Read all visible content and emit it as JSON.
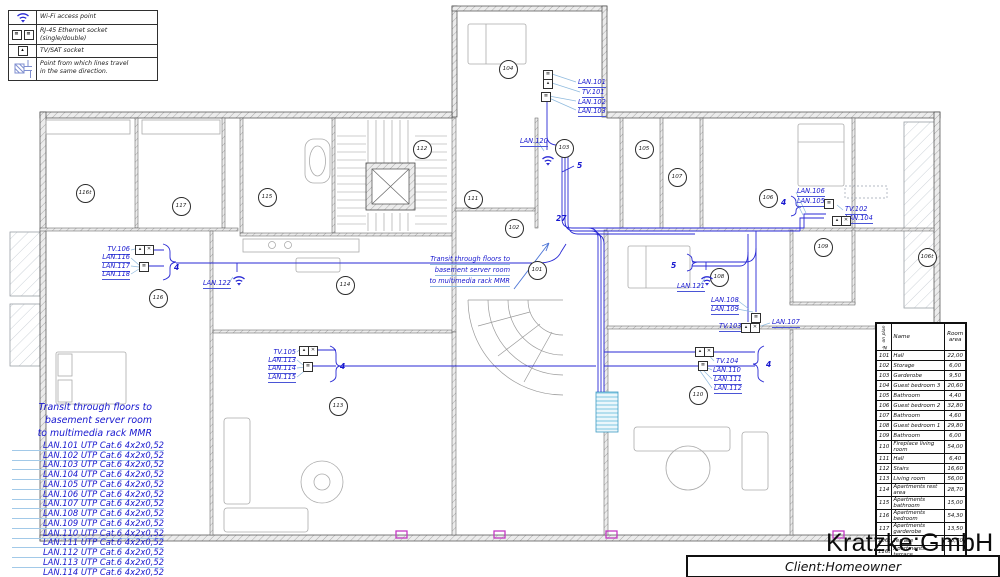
{
  "legend": {
    "items": [
      {
        "icon": "wifi-icon",
        "label": "Wi-Fi access point"
      },
      {
        "icon": "rj45-double-icon",
        "label": "RJ-45 Ethernet socket (single/double)"
      },
      {
        "icon": "tv-sat-icon",
        "label": "TV/SAT socket"
      },
      {
        "icon": "direction-icon",
        "label": "Point from which lines travel\nin the same direction."
      }
    ]
  },
  "notes": {
    "center": [
      "Transit through floors to",
      "basement server room",
      "to multimedia rack MMR"
    ],
    "bottom": [
      "Transit through floors to",
      "basement server room",
      "to multimedia rack MMR"
    ]
  },
  "cable_list": [
    "LAN.101 UTP Cat.6 4x2x0,52",
    "LAN.102 UTP Cat.6 4x2x0,52",
    "LAN.103 UTP Cat.6 4x2x0,52",
    "LAN.104 UTP Cat.6 4x2x0,52",
    "LAN.105 UTP Cat.6 4x2x0,52",
    "LAN.106 UTP Cat.6 4x2x0,52",
    "LAN.107 UTP Cat.6 4x2x0,52",
    "LAN.108 UTP Cat.6 4x2x0,52",
    "LAN.109 UTP Cat.6 4x2x0,52",
    "LAN.110 UTP Cat.6 4x2x0,52",
    "LAN.111 UTP Cat.6 4x2x0,52",
    "LAN.112 UTP Cat.6 4x2x0,52",
    "LAN.113 UTP Cat.6 4x2x0,52",
    "LAN.114 UTP Cat.6 4x2x0,52"
  ],
  "plan": {
    "rooms": [
      {
        "id": "104",
        "x": 507,
        "y": 68
      },
      {
        "id": "112",
        "x": 421,
        "y": 148
      },
      {
        "id": "103",
        "x": 563,
        "y": 147
      },
      {
        "id": "105",
        "x": 643,
        "y": 148
      },
      {
        "id": "107",
        "x": 676,
        "y": 176
      },
      {
        "id": "116t",
        "x": 84,
        "y": 192
      },
      {
        "id": "117",
        "x": 180,
        "y": 205
      },
      {
        "id": "115",
        "x": 266,
        "y": 196
      },
      {
        "id": "111",
        "x": 472,
        "y": 198
      },
      {
        "id": "106",
        "x": 767,
        "y": 197
      },
      {
        "id": "102",
        "x": 513,
        "y": 227
      },
      {
        "id": "109",
        "x": 822,
        "y": 246
      },
      {
        "id": "106t",
        "x": 926,
        "y": 256
      },
      {
        "id": "101",
        "x": 536,
        "y": 269
      },
      {
        "id": "108",
        "x": 718,
        "y": 276
      },
      {
        "id": "116",
        "x": 157,
        "y": 297
      },
      {
        "id": "114",
        "x": 344,
        "y": 284
      },
      {
        "id": "113",
        "x": 337,
        "y": 405
      },
      {
        "id": "110",
        "x": 697,
        "y": 394
      }
    ],
    "labels": [
      {
        "t": "LAN.101",
        "x": 578,
        "y": 79,
        "a": "l"
      },
      {
        "t": "TV.101",
        "x": 582,
        "y": 89,
        "a": "l"
      },
      {
        "t": "LAN.102",
        "x": 578,
        "y": 99,
        "a": "l"
      },
      {
        "t": "LAN.103",
        "x": 578,
        "y": 108,
        "a": "l"
      },
      {
        "t": "TV.106",
        "x": 130,
        "y": 246,
        "a": "r"
      },
      {
        "t": "LAN.116",
        "x": 130,
        "y": 254,
        "a": "r"
      },
      {
        "t": "LAN.117",
        "x": 130,
        "y": 263,
        "a": "r"
      },
      {
        "t": "LAN.118",
        "x": 130,
        "y": 271,
        "a": "r"
      },
      {
        "t": "TV.105",
        "x": 296,
        "y": 349,
        "a": "r"
      },
      {
        "t": "LAN.113",
        "x": 296,
        "y": 357,
        "a": "r"
      },
      {
        "t": "LAN.114",
        "x": 296,
        "y": 365,
        "a": "r"
      },
      {
        "t": "LAN.115",
        "x": 296,
        "y": 374,
        "a": "r"
      },
      {
        "t": "TV.104",
        "x": 716,
        "y": 358,
        "a": "l"
      },
      {
        "t": "LAN.110",
        "x": 713,
        "y": 367,
        "a": "l"
      },
      {
        "t": "LAN.111",
        "x": 714,
        "y": 376,
        "a": "l"
      },
      {
        "t": "LAN.112",
        "x": 714,
        "y": 385,
        "a": "l"
      },
      {
        "t": "LAN.106",
        "x": 797,
        "y": 188,
        "a": "l"
      },
      {
        "t": "LAN.105",
        "x": 797,
        "y": 198,
        "a": "l"
      },
      {
        "t": "TV.102",
        "x": 845,
        "y": 206,
        "a": "l"
      },
      {
        "t": "LAN.104",
        "x": 845,
        "y": 215,
        "a": "l"
      },
      {
        "t": "LAN.121",
        "x": 677,
        "y": 283,
        "a": "l"
      },
      {
        "t": "LAN.108",
        "x": 711,
        "y": 297,
        "a": "l"
      },
      {
        "t": "LAN.109",
        "x": 711,
        "y": 306,
        "a": "l"
      },
      {
        "t": "TV.103",
        "x": 719,
        "y": 323,
        "a": "l"
      },
      {
        "t": "LAN.107",
        "x": 772,
        "y": 319,
        "a": "l"
      },
      {
        "t": "LAN.120",
        "x": 520,
        "y": 138,
        "a": "l"
      },
      {
        "t": "LAN.122",
        "x": 203,
        "y": 280,
        "a": "l"
      },
      {
        "t": "4",
        "x": 174,
        "y": 264,
        "a": "l",
        "c": 1
      },
      {
        "t": "4",
        "x": 340,
        "y": 363,
        "a": "l",
        "c": 1
      },
      {
        "t": "4",
        "x": 781,
        "y": 199,
        "a": "l",
        "c": 1
      },
      {
        "t": "4",
        "x": 766,
        "y": 361,
        "a": "l",
        "c": 1
      },
      {
        "t": "5",
        "x": 577,
        "y": 162,
        "a": "l",
        "c": 1
      },
      {
        "t": "5",
        "x": 671,
        "y": 262,
        "a": "l",
        "c": 1
      },
      {
        "t": "27",
        "x": 556,
        "y": 215,
        "a": "l",
        "c": 1
      }
    ],
    "sockets": [
      {
        "x": 543,
        "y": 70,
        "g": "≣"
      },
      {
        "x": 543,
        "y": 79,
        "g": "▴"
      },
      {
        "x": 541,
        "y": 92,
        "g": "≣"
      },
      {
        "x": 135,
        "y": 245,
        "g": "▴"
      },
      {
        "x": 144,
        "y": 245,
        "g": "✕"
      },
      {
        "x": 139,
        "y": 262,
        "g": "≣"
      },
      {
        "x": 299,
        "y": 346,
        "g": "▴"
      },
      {
        "x": 308,
        "y": 346,
        "g": "✕"
      },
      {
        "x": 303,
        "y": 362,
        "g": "≣"
      },
      {
        "x": 695,
        "y": 347,
        "g": "▴"
      },
      {
        "x": 704,
        "y": 347,
        "g": "✕"
      },
      {
        "x": 698,
        "y": 361,
        "g": "≣"
      },
      {
        "x": 824,
        "y": 199,
        "g": "≣"
      },
      {
        "x": 832,
        "y": 216,
        "g": "▴"
      },
      {
        "x": 841,
        "y": 216,
        "g": "✕"
      },
      {
        "x": 751,
        "y": 313,
        "g": "≣"
      },
      {
        "x": 741,
        "y": 323,
        "g": "▴"
      },
      {
        "x": 750,
        "y": 323,
        "g": "✕"
      }
    ],
    "wifi": [
      {
        "x": 541,
        "y": 151
      },
      {
        "x": 700,
        "y": 271
      },
      {
        "x": 232,
        "y": 271
      }
    ]
  },
  "table": {
    "headers": [
      "№ on plan",
      "Name",
      "Room area"
    ],
    "rows": [
      [
        "101",
        "Hall",
        "22,00"
      ],
      [
        "102",
        "Storage",
        "6,00"
      ],
      [
        "103",
        "Garderobe",
        "9,50"
      ],
      [
        "104",
        "Guest bedroom 3",
        "20,60"
      ],
      [
        "105",
        "Bathroom",
        "4,40"
      ],
      [
        "106",
        "Guest bedroom 2",
        "32,80"
      ],
      [
        "107",
        "Bathroom",
        "4,60"
      ],
      [
        "108",
        "Guest bedroom 1",
        "29,80"
      ],
      [
        "109",
        "Bathroom",
        "6,00"
      ],
      [
        "110",
        "Fireplace living room",
        "54,00"
      ],
      [
        "111",
        "Hall",
        "6,40"
      ],
      [
        "112",
        "Stairs",
        "16,60"
      ],
      [
        "113",
        "Living room",
        "56,00"
      ],
      [
        "114",
        "Apartments rest area",
        "28,70"
      ],
      [
        "115",
        "Apartments bathroom",
        "15,00"
      ],
      [
        "116",
        "Apartments bedroom",
        "54,30"
      ],
      [
        "117",
        "Apartments garderobe",
        "13,50"
      ],
      [
        "106t",
        "Terrace",
        "23,70"
      ],
      [
        "116t",
        "Apartments terrace",
        ""
      ]
    ]
  },
  "titleblock": {
    "company": "Kratzke:GmbH",
    "client": "Client:Homeowner"
  }
}
